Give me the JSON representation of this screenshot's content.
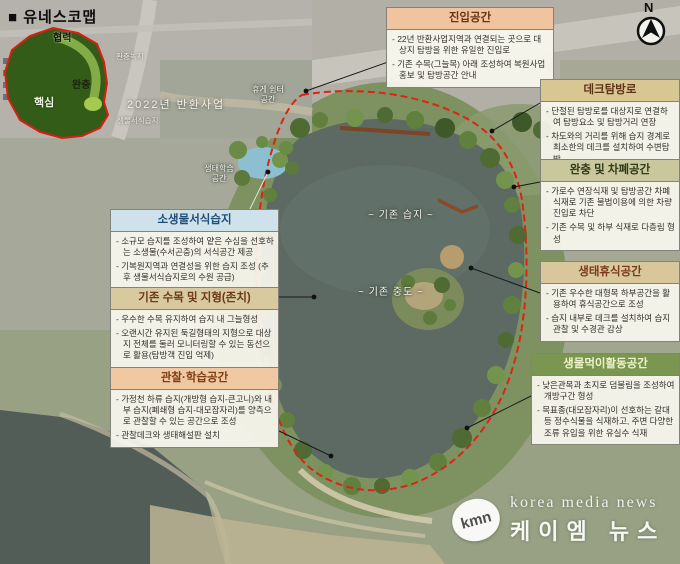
{
  "inset": {
    "title": "■ 유네스코맵",
    "labels": {
      "cooperation": "협력",
      "buffer": "완충",
      "core": "핵심",
      "buffer_green": "완충녹지",
      "project_2022": "2022년 반환사업",
      "bio_habitat": "생물서식습지"
    }
  },
  "compass": {
    "label": "N"
  },
  "map_labels": {
    "existing_wetland": "~ 기존 습지 ~",
    "existing_island": "~ 기존 중도 ~",
    "eco_learning_line1": "생태학습",
    "eco_learning_line2": "공간",
    "rest_line1": "휴게 쉼터",
    "rest_line2": "공간"
  },
  "callouts": [
    {
      "id": "entry-space",
      "title": "진입공간",
      "header_bg": "#efc49e",
      "header_fg": "#6b3413",
      "bullets": [
        "22년 반환사업지역과 연결되는 곳으로 대상지 탐방을 위한 유일한 진입로",
        "기존 수목(그늘목) 아래 조성하여 복원사업 홍보 및 탐방공간 안내"
      ]
    },
    {
      "id": "deck-trail",
      "title": "데크탐방로",
      "header_bg": "#d8c693",
      "header_fg": "#5f3318",
      "bullets": [
        "단절된 탐방로를 대상지로 연결하여 탐방요소 및 탐방거리 연장",
        "차도와의 거리를 위해 습지 경계로 최소한의 데크를 설치하여 수변탐방"
      ]
    },
    {
      "id": "buffer-screen-space",
      "title": "완충 및 차폐공간",
      "header_bg": "#c9c79c",
      "header_fg": "#32391c",
      "bullets": [
        "가로수 연장식재 및 탐방공간 차폐식재로 기존 불법이용에 의한 차량진입로 차단",
        "기존 수목 및 하부 식재로 다층림 형성"
      ]
    },
    {
      "id": "eco-rest-space",
      "title": "생태휴식공간",
      "header_bg": "#d9c79c",
      "header_fg": "#7a3a1a",
      "bullets": [
        "기존 우수한 대형목 하부공간을 활용하여 휴식공간으로 조성",
        "습지 내부로 데크를 설치하여 습지 관찰 및 수경관 감상"
      ]
    },
    {
      "id": "feeding-activity-space",
      "title": "생물먹이활동공간",
      "header_bg": "#7a9650",
      "header_fg": "#ecf3c8",
      "bullets": [
        "낮은관목과 초지로 덤불림을 조성하여 개방구간 형성",
        "목표종(대모잠자리)이 선호하는 갈대 등 정수식물을 식재하고, 주변 다양한 조류 유입을 위한 유실수 식재"
      ]
    },
    {
      "id": "small-creature-wetland",
      "title": "소생물서식습지",
      "header_bg": "#cfe2ec",
      "header_fg": "#1e4e7a",
      "bullets": [
        "소규모 습지를 조성하여 얕은 수심을 선호하는 소생물(수서곤충)의 서식공간 제공",
        "기복원지역과 연결성을 위한 습지 조성 (추후 생물서식습지로의 수원 공급)"
      ]
    },
    {
      "id": "existing-trees-terrain",
      "title": "기존 수목 및 지형(존치)",
      "header_bg": "#d8c99f",
      "header_fg": "#6b3a16",
      "bullets": [
        "우수한 수목 유지하여 습지 내 그늘형성",
        "오랜시간 유지된 둑길형태의 지형으로 대상지 전체를 둘러 모니터링할 수 있는 동선으로 활용(탐방객 진입 억제)"
      ]
    },
    {
      "id": "observe-learn-space",
      "title": "관찰·학습공간",
      "header_bg": "#f0c8a2",
      "header_fg": "#7e3f14",
      "bullets": [
        "가정천 하류 습지(개방형 습지-큰고니)와 내부 습지(폐쇄형 습지-대모잠자리)를 양측으로 관찰할 수 있는 공간으로 조성",
        "관찰데크와 생태해설판 설치"
      ]
    }
  ],
  "watermark": {
    "logo": "kmn",
    "line1": "korea media news",
    "line2": "케이엠 뉴스"
  },
  "colors": {
    "boundary_red": "#dd2314",
    "lake": "#5c6a63",
    "pond": "#8cc0d0"
  }
}
